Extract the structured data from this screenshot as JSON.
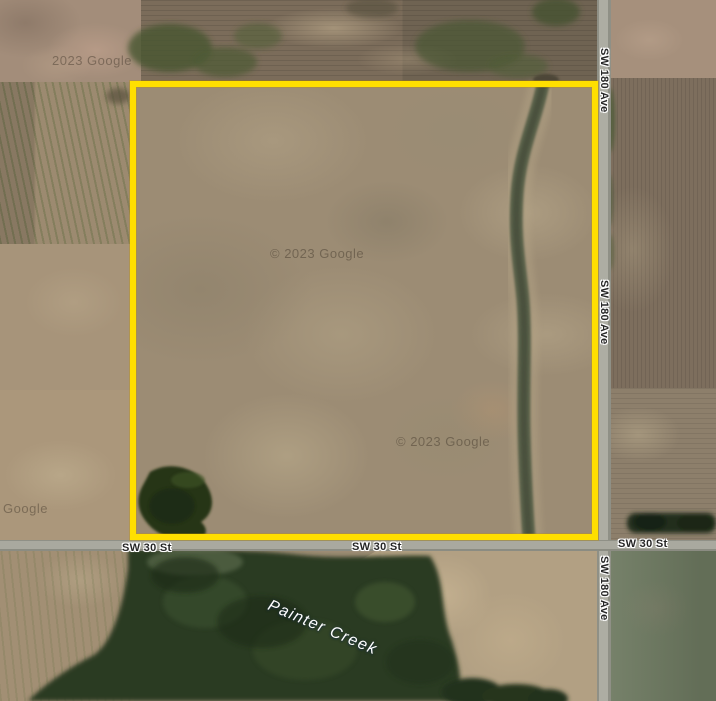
{
  "roads": {
    "sw_180_ave": {
      "name": "SW 180 Ave"
    },
    "sw_30_st": {
      "name": "SW 30 St"
    }
  },
  "water": {
    "creek_name": "Painter Creek"
  },
  "attribution": {
    "text": "2023 Google",
    "text_with_symbol": "© 2023 Google"
  },
  "parcel": {
    "outline_color": "#FFDF00"
  },
  "colors": {
    "road": "#A9A99F",
    "forest": "#2A3A22",
    "field_tan": "#9C8C74",
    "pasture": "#6E7A61",
    "waterway": "#596048",
    "label_text": "#262626",
    "creek_label_text": "#FFFFFF"
  }
}
